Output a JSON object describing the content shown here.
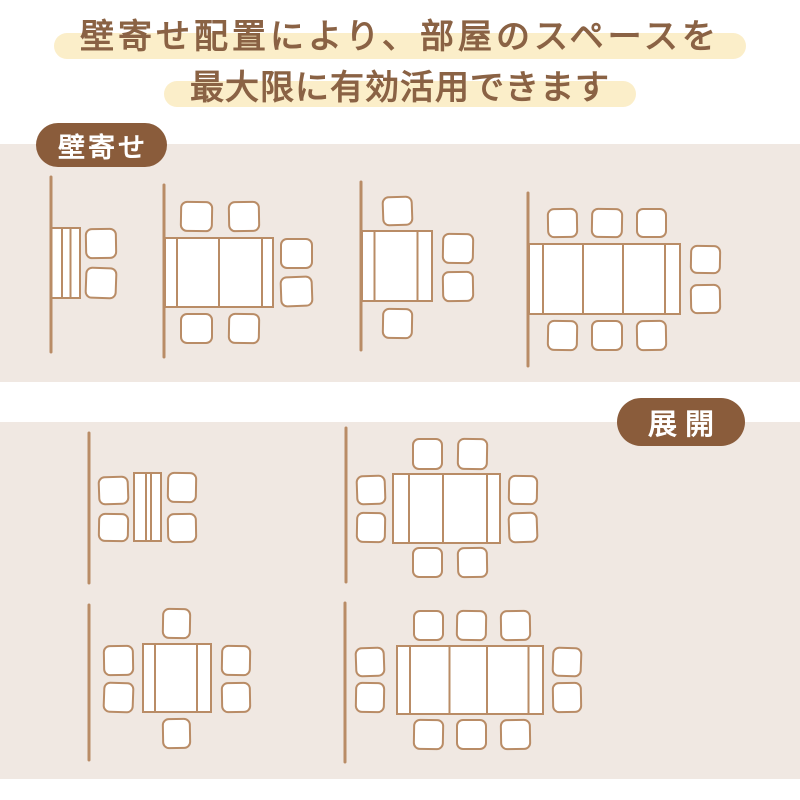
{
  "heading": {
    "line1": "壁寄せ配置により、部屋のスペースを",
    "line2": "最大限に有効活用できます"
  },
  "colors": {
    "section_bg": "#f0e8e2",
    "highlight_bg": "#fbeec9",
    "heading_text": "#8a6244",
    "badge_bg": "#8a5c3b",
    "badge_text": "#ffffff",
    "stroke": "#b98c66",
    "furniture_fill": "#ffffff"
  },
  "sections": [
    {
      "label": "壁寄せ",
      "diagrams": [
        {
          "name": "folded-table-2-chairs",
          "chairs_count": 2,
          "wall": {
            "x": 51,
            "y1": 177,
            "y2": 352
          },
          "table": {
            "x": 51.5,
            "y": 228,
            "w": 28.5,
            "h": 70,
            "dividers": [
              10.5,
              19
            ]
          },
          "chairs": [
            {
              "x": 86,
              "y": 229,
              "w": 30,
              "h": 29,
              "r": -1
            },
            {
              "x": 86,
              "y": 268,
              "w": 30,
              "h": 30,
              "r": 2
            }
          ]
        },
        {
          "name": "half-extended-table-6-chairs",
          "chairs_count": 6,
          "wall": {
            "x": 164,
            "y1": 185,
            "y2": 357
          },
          "table": {
            "x": 165,
            "y": 238,
            "w": 108,
            "h": 69,
            "dividers": [
              12,
              54,
              97
            ]
          },
          "chairs": [
            {
              "x": 181,
              "y": 202,
              "w": 31,
              "h": 29,
              "r": 1
            },
            {
              "x": 229,
              "y": 202,
              "w": 30,
              "h": 29,
              "r": -1
            },
            {
              "x": 281,
              "y": 239,
              "w": 31,
              "h": 29,
              "r": 0
            },
            {
              "x": 281,
              "y": 277,
              "w": 31,
              "h": 29,
              "r": -2
            },
            {
              "x": 181,
              "y": 314,
              "w": 31,
              "h": 29,
              "r": 0
            },
            {
              "x": 229,
              "y": 314,
              "w": 30,
              "h": 29,
              "r": 1
            }
          ]
        },
        {
          "name": "compact-table-4-chairs",
          "chairs_count": 4,
          "wall": {
            "x": 361,
            "y1": 182,
            "y2": 350
          },
          "table": {
            "x": 362,
            "y": 231,
            "w": 70,
            "h": 70,
            "dividers": [
              12.5,
              55.5
            ]
          },
          "chairs": [
            {
              "x": 383,
              "y": 197,
              "w": 29,
              "h": 28,
              "r": -2
            },
            {
              "x": 443,
              "y": 234,
              "w": 30,
              "h": 29,
              "r": 1
            },
            {
              "x": 443,
              "y": 272,
              "w": 30,
              "h": 29,
              "r": -1
            },
            {
              "x": 383,
              "y": 309,
              "w": 29,
              "h": 29,
              "r": 1
            }
          ]
        },
        {
          "name": "fully-extended-table-8-chairs",
          "chairs_count": 8,
          "wall": {
            "x": 528,
            "y1": 193,
            "y2": 366
          },
          "table": {
            "x": 529,
            "y": 244,
            "w": 151,
            "h": 70,
            "dividers": [
              14,
              54,
              94,
              136
            ]
          },
          "chairs": [
            {
              "x": 548,
              "y": 209,
              "w": 29,
              "h": 28,
              "r": -1
            },
            {
              "x": 592,
              "y": 209,
              "w": 30,
              "h": 28,
              "r": 1
            },
            {
              "x": 637,
              "y": 209,
              "w": 29,
              "h": 28,
              "r": 0
            },
            {
              "x": 691,
              "y": 246,
              "w": 29,
              "h": 27,
              "r": 1
            },
            {
              "x": 691,
              "y": 285,
              "w": 29,
              "h": 28,
              "r": -1
            },
            {
              "x": 548,
              "y": 321,
              "w": 29,
              "h": 29,
              "r": 1
            },
            {
              "x": 592,
              "y": 321,
              "w": 30,
              "h": 29,
              "r": 0
            },
            {
              "x": 637,
              "y": 321,
              "w": 29,
              "h": 29,
              "r": -1
            }
          ]
        }
      ]
    },
    {
      "label": "展開",
      "diagrams": [
        {
          "name": "folded-table-4-chairs",
          "chairs_count": 4,
          "wall": {
            "x": 89,
            "y1": 433,
            "y2": 583
          },
          "table": {
            "x": 134,
            "y": 473,
            "w": 27,
            "h": 68,
            "dividers": [
              12,
              17
            ]
          },
          "chairs": [
            {
              "x": 99,
              "y": 477,
              "w": 29,
              "h": 27,
              "r": -2
            },
            {
              "x": 99,
              "y": 514,
              "w": 29,
              "h": 27,
              "r": 1
            },
            {
              "x": 168,
              "y": 473,
              "w": 28,
              "h": 29,
              "r": 1
            },
            {
              "x": 168,
              "y": 514,
              "w": 28,
              "h": 28,
              "r": -1
            }
          ]
        },
        {
          "name": "extended-table-8-chairs",
          "chairs_count": 8,
          "wall": {
            "x": 346,
            "y1": 428,
            "y2": 582
          },
          "table": {
            "x": 393,
            "y": 474,
            "w": 107,
            "h": 69,
            "dividers": [
              16,
              50,
              94
            ]
          },
          "chairs": [
            {
              "x": 413,
              "y": 439,
              "w": 29,
              "h": 30,
              "r": 0
            },
            {
              "x": 458,
              "y": 439,
              "w": 29,
              "h": 30,
              "r": 1
            },
            {
              "x": 357,
              "y": 476,
              "w": 28,
              "h": 28,
              "r": -2
            },
            {
              "x": 357,
              "y": 513,
              "w": 28,
              "h": 29,
              "r": 1
            },
            {
              "x": 509,
              "y": 476,
              "w": 28,
              "h": 28,
              "r": 1
            },
            {
              "x": 509,
              "y": 513,
              "w": 28,
              "h": 29,
              "r": -2
            },
            {
              "x": 413,
              "y": 548,
              "w": 29,
              "h": 29,
              "r": 0
            },
            {
              "x": 458,
              "y": 548,
              "w": 29,
              "h": 29,
              "r": -1
            }
          ]
        },
        {
          "name": "compact-table-6-chairs",
          "chairs_count": 6,
          "wall": {
            "x": 89,
            "y1": 605,
            "y2": 760
          },
          "table": {
            "x": 143,
            "y": 644,
            "w": 68,
            "h": 68,
            "dividers": [
              12,
              54
            ]
          },
          "chairs": [
            {
              "x": 163,
              "y": 609,
              "w": 27,
              "h": 29,
              "r": 1
            },
            {
              "x": 104,
              "y": 646,
              "w": 29,
              "h": 29,
              "r": -1
            },
            {
              "x": 104,
              "y": 683,
              "w": 29,
              "h": 29,
              "r": 2
            },
            {
              "x": 222,
              "y": 646,
              "w": 28,
              "h": 29,
              "r": 1
            },
            {
              "x": 222,
              "y": 683,
              "w": 28,
              "h": 29,
              "r": -1
            },
            {
              "x": 163,
              "y": 719,
              "w": 27,
              "h": 29,
              "r": -1
            }
          ]
        },
        {
          "name": "fully-extended-table-10-chairs",
          "chairs_count": 10,
          "wall": {
            "x": 345,
            "y1": 603,
            "y2": 762
          },
          "table": {
            "x": 397,
            "y": 646,
            "w": 146,
            "h": 68,
            "dividers": [
              13,
              52.5,
              90,
              131.5
            ]
          },
          "chairs": [
            {
              "x": 414,
              "y": 611,
              "w": 29,
              "h": 29,
              "r": 0
            },
            {
              "x": 457,
              "y": 611,
              "w": 29,
              "h": 29,
              "r": 1
            },
            {
              "x": 501,
              "y": 611,
              "w": 29,
              "h": 29,
              "r": -1
            },
            {
              "x": 356,
              "y": 648,
              "w": 28,
              "h": 28,
              "r": -2
            },
            {
              "x": 356,
              "y": 683,
              "w": 28,
              "h": 29,
              "r": 1
            },
            {
              "x": 553,
              "y": 648,
              "w": 28,
              "h": 28,
              "r": 2
            },
            {
              "x": 553,
              "y": 683,
              "w": 28,
              "h": 29,
              "r": -1
            },
            {
              "x": 414,
              "y": 720,
              "w": 29,
              "h": 29,
              "r": 1
            },
            {
              "x": 457,
              "y": 720,
              "w": 29,
              "h": 29,
              "r": 0
            },
            {
              "x": 501,
              "y": 720,
              "w": 29,
              "h": 29,
              "r": -1
            }
          ]
        }
      ]
    }
  ]
}
